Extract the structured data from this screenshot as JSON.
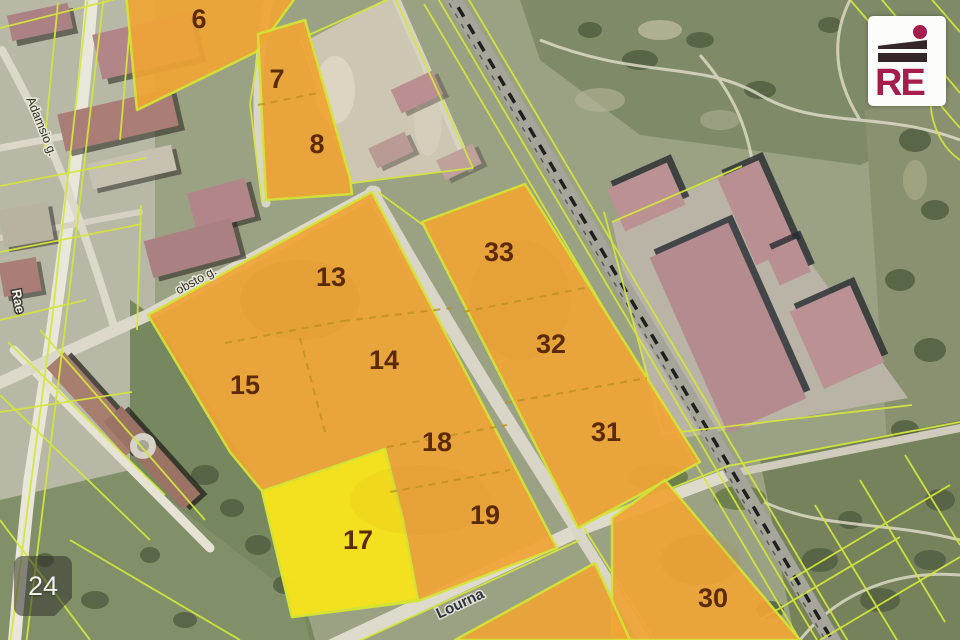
{
  "map": {
    "parcels": [
      {
        "number": "6"
      },
      {
        "number": "7"
      },
      {
        "number": "8"
      },
      {
        "number": "13"
      },
      {
        "number": "14"
      },
      {
        "number": "15"
      },
      {
        "number": "17"
      },
      {
        "number": "18"
      },
      {
        "number": "19"
      },
      {
        "number": "30"
      },
      {
        "number": "31"
      },
      {
        "number": "32"
      },
      {
        "number": "33"
      }
    ],
    "streets": [
      {
        "name": "Adamsio g."
      },
      {
        "name": "Rae"
      },
      {
        "name": "obsto g."
      },
      {
        "name": "Lourna"
      }
    ],
    "highlight_colors": {
      "parcel_fill": "#f0a435",
      "selected_parcel_fill": "#f3e41c",
      "boundary_line": "#d3e435",
      "parcel_number_text": "#5b2b06"
    }
  },
  "logo": {
    "text": "RE",
    "accent_color": "#a61c4c",
    "bar_color": "#35262a"
  },
  "photo_badge": {
    "count": "24"
  }
}
